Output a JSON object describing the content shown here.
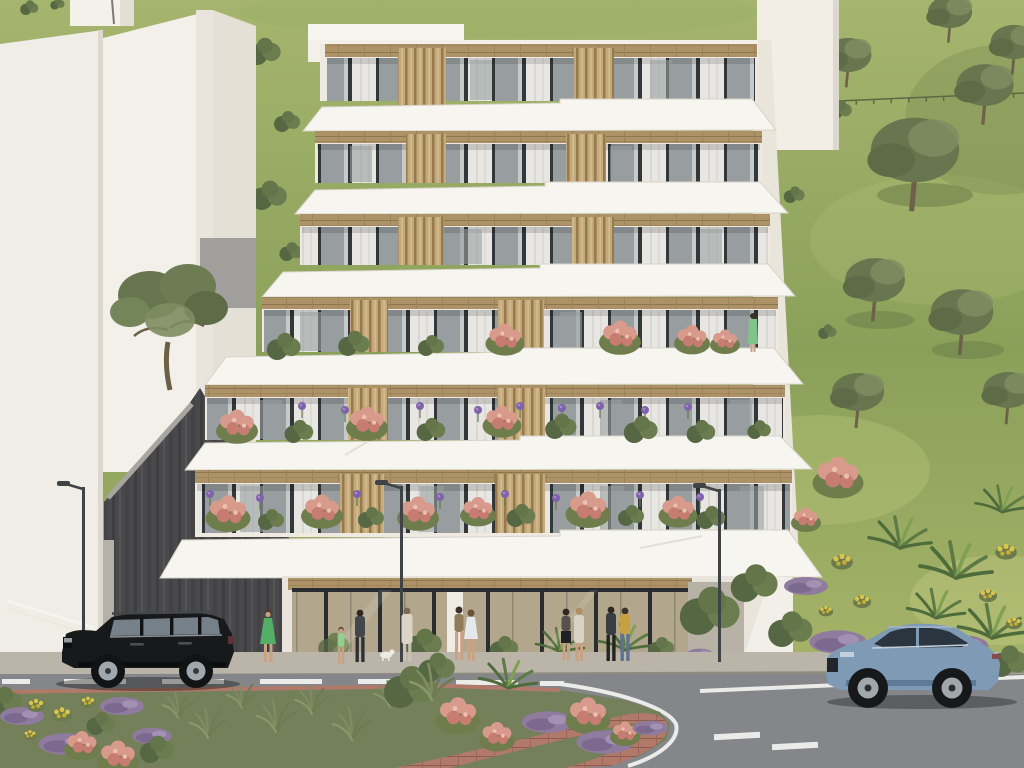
{
  "scene": {
    "type": "architectural-rendering",
    "description": "Photorealistic exterior render of a modern terraced apartment building on a hillside street. Six stepped residential floors with cantilevered white balcony slabs, wood soffits, vertical timber slat screens and glass sliding doors sit above a glazed ground-floor storefront. Flower planters with roses and purple alliums line the balconies. A grassy olive-tree hill rises behind, a white neighbouring building stands to the left, and a road with a planted roundabout island, pedestrians, street lamps, a black SUV and a blue SUV crosses the foreground.",
    "time_of_day": "daytime",
    "inventory": [
      "apartment-building",
      "neighbour-building",
      "retaining-wall",
      "olive-trees",
      "hillside-lawn",
      "storefront",
      "pedestrians",
      "black-suv",
      "blue-suv",
      "street-lamps",
      "roundabout-island",
      "flower-beds"
    ]
  },
  "building": {
    "name": "terraced-apartment-building",
    "floors_visible": 6,
    "balcony_planting": [
      "pink roses",
      "green shrubs",
      "purple alliums"
    ],
    "materials": [
      "white concrete slabs",
      "timber slats",
      "glass sliding doors",
      "wood soffits"
    ]
  },
  "vehicles": [
    {
      "label": "black-suv",
      "style": "Range-Rover-like SUV",
      "facing": "left",
      "color": "#17191b"
    },
    {
      "label": "blue-suv",
      "style": "Audi-Q8-like SUV",
      "facing": "left",
      "color": "#7e9ab5"
    }
  ],
  "people": [
    {
      "label": "woman-green-dress",
      "color": "#53ae66"
    },
    {
      "label": "child-light-green",
      "color": "#93cf8d"
    },
    {
      "label": "man-dark-jacket-a",
      "color": "#43464a"
    },
    {
      "label": "person-cream-coat",
      "color": "#dcd5c6"
    },
    {
      "label": "woman-olive-top",
      "color": "#8d7c57"
    },
    {
      "label": "woman-white-dress",
      "color": "#e4e8ea"
    },
    {
      "label": "woman-dark-top",
      "color": "#57504c"
    },
    {
      "label": "woman-cream-cardigan",
      "color": "#d9d3c5"
    },
    {
      "label": "man-dark-jacket-b",
      "color": "#3a3d40"
    },
    {
      "label": "man-mustard-jacket",
      "color": "#c7a03f"
    },
    {
      "label": "balcony-woman-mint",
      "color": "#7fc489"
    }
  ],
  "street": {
    "lamp_count": 3,
    "roundabout": true,
    "lane_marking": "white dashes",
    "pavers": "terracotta brick"
  },
  "colors": {
    "grass_top": "#a6b56e",
    "grass_mid": "#8aa059",
    "grass_low": "#a8b56a",
    "tree_olive": "#67764f",
    "tree_olive_light": "#7e8d60",
    "trunk": "#6e604a",
    "wall_white": "#f0ede6",
    "wall_face_b": "#f3f0ea",
    "wall_face_c": "#e4e0d6",
    "core_wall": "#f2eee6",
    "side_wall": "#eae5da",
    "slab_white": "#f7f5f0",
    "slab_edge": "#d8d3c7",
    "wood": "#ac9266",
    "wood_dark": "#8d7550",
    "slat": "#c3a97c",
    "slat_dark": "#97794e",
    "frame_dark": "#32373a",
    "glass_pane": "#c6cac9",
    "glass_dark": "#989ea0",
    "curtain": "#e7e6e2",
    "dark_wall": "#49494c",
    "dark_wall_streak": "#3e3e41",
    "dark_wall_light": "#b5b1a9",
    "store_glass": "#b2a78d",
    "store_frame": "#2a2d2f",
    "sidewalk": "#bab5a8",
    "curb": "#908b7f",
    "road": "#85868a",
    "marking": "#ebebe9",
    "brick": "#b0796a",
    "brick_line": "#8d5c4f",
    "island_green": "#74805a",
    "lavender": "#8f7b9e",
    "yellow_flower": "#d9c54e",
    "rose": "#d89a8b",
    "rose_dark": "#c67c70",
    "bush_dark": "#566743",
    "bush_green": "#6b7c4f",
    "grass_tuft": "#7e8c60",
    "palm_green": "#4e6b3c",
    "suv_glass": "#768088",
    "rim": "#a0a7ad",
    "car_blue_dark": "#5e7c99",
    "car_glass_dark": "#2b353f",
    "lamp_gray": "#404346",
    "skin": "#c9a183",
    "allium": "#7e63ab",
    "dog_white": "#eceae4"
  }
}
